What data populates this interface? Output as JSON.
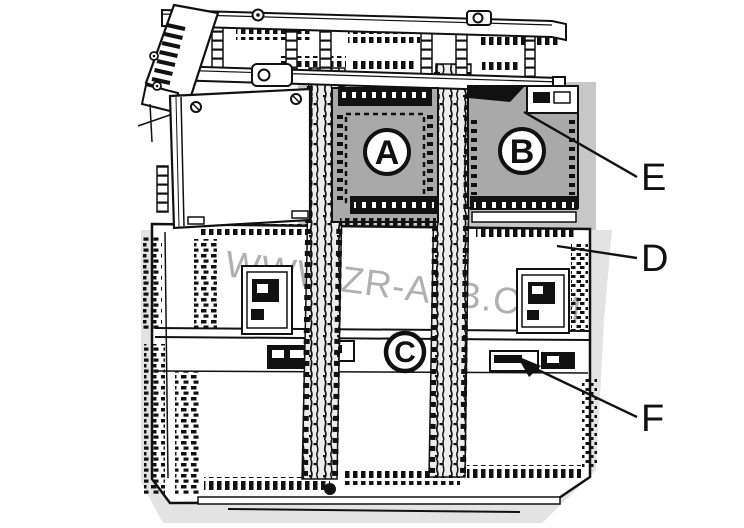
{
  "figure": {
    "type": "technical-illustration",
    "description": "Exploded line-art view of modular controller hardware with DIN rail, cable ducts and base unit",
    "watermark": "WWW.ZR-ABB.COM",
    "module_labels": {
      "a": "A",
      "b": "B",
      "c": "C"
    },
    "callouts": {
      "e": "E",
      "d": "D",
      "f": "F"
    },
    "colors": {
      "line": "#111111",
      "module_fill": "#a9a9a9",
      "backdrop_mid": "#c7c7c7",
      "backdrop_light": "#e3e3e3",
      "duct_fill": "#ededed",
      "watermark": "#a8a8a8",
      "panel_fill": "#ffffff"
    }
  }
}
